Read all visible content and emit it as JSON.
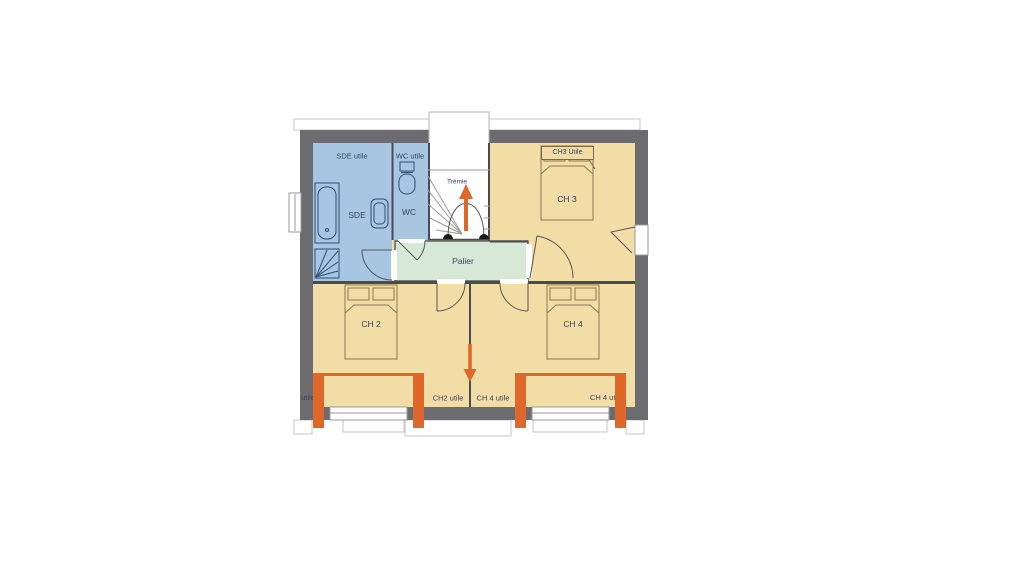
{
  "page": {
    "background": "#ffffff",
    "description": "House floor plan, upper floor"
  },
  "palette": {
    "wall_gray": "#6c6c70",
    "bathroom_blue": "#a6c6e1",
    "bedroom_cream": "#f3dda6",
    "landing_green": "#d8e8d6",
    "accent_orange": "#e0672a",
    "white": "#ffffff",
    "line_dark": "#4a4a50",
    "stair_line": "#9a9aa0",
    "fixture_blue": "#2f4e6e",
    "bed_line": "#8a7750",
    "text_dark": "#36455f",
    "newel_black": "#1a1a1a",
    "outline_light": "#c6c6ca"
  },
  "rooms": {
    "sde": {
      "label": "SDE",
      "area_label": "SDE utile"
    },
    "wc": {
      "label": "WC",
      "area_label": "WC utile"
    },
    "stairwell": {
      "label": "Trémie"
    },
    "ch3": {
      "label": "CH 3",
      "area_label": "CH3 Utile"
    },
    "palier": {
      "label": "Palier"
    },
    "ch2": {
      "label": "CH 2",
      "area_label": "CH2 utile"
    },
    "ch4": {
      "label": "CH 4",
      "area_label": "CH 4 utile"
    }
  },
  "icons": {
    "stair_up_arrow": "orange upward arrow inside staircase",
    "entry_axis_arrow": "orange downward arrow on central wall axis"
  }
}
